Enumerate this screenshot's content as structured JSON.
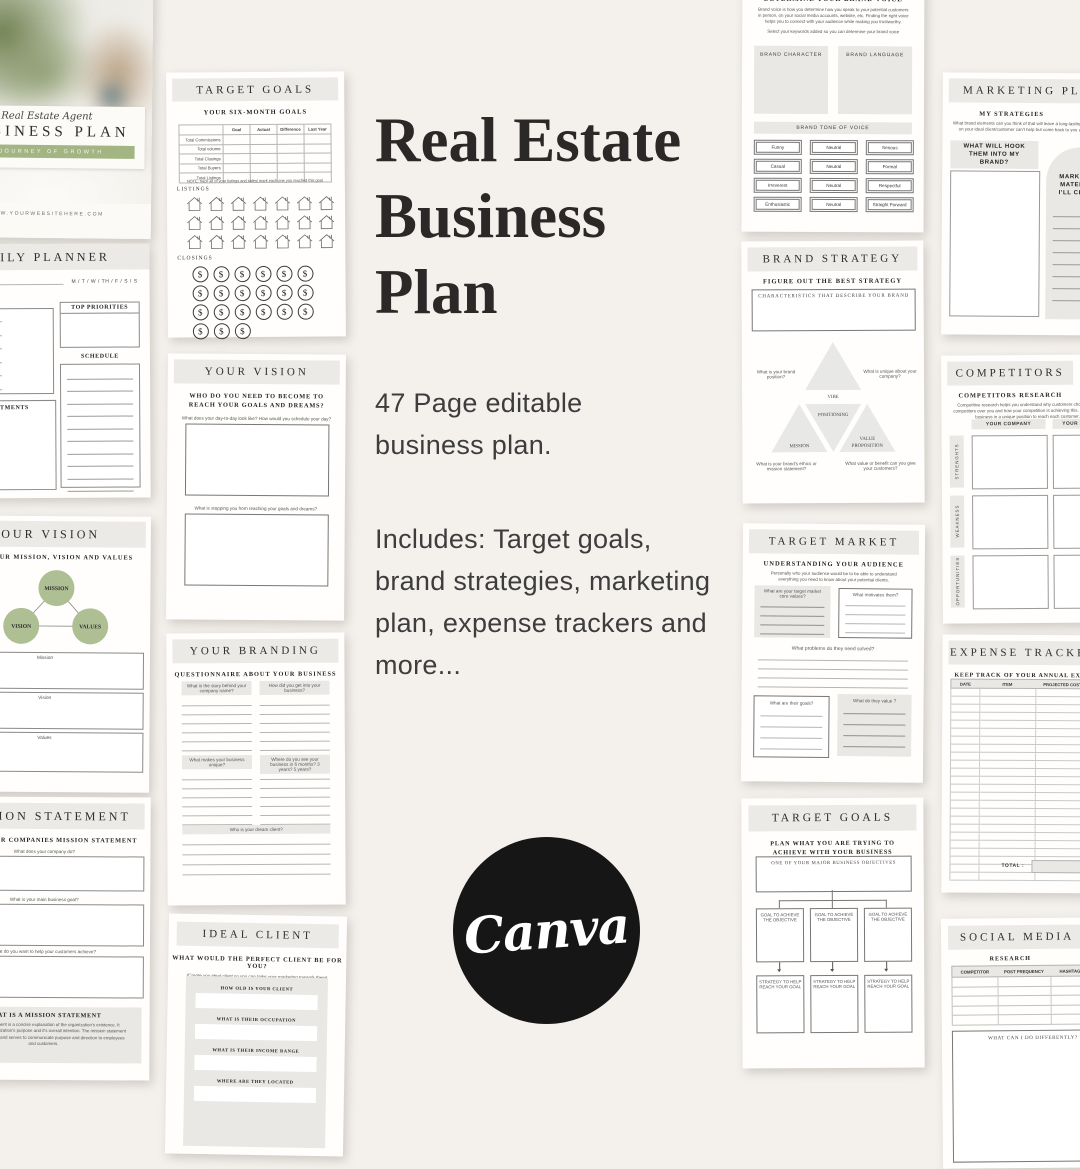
{
  "colors": {
    "bg": "#f4f1ed",
    "paper": "#fffefc",
    "band": "#ebeae7",
    "sage": "#aebf94",
    "sage_dark": "#a3b583",
    "canva": "#161616"
  },
  "center": {
    "title1": "Real Estate",
    "title2": "Business",
    "title3": "Plan",
    "p1": "47 Page editable business plan.",
    "p2": "Includes: Target goals, brand strategies, marketing plan, expense trackers and more...",
    "canva": "Canva"
  },
  "cover": {
    "script": "Real Estate Agent",
    "title": "BUSINESS PLAN",
    "banner": "A JOURNEY OF GROWTH",
    "site": "WWW.YOURWEBSITEHERE.COM"
  },
  "daily": {
    "title": "DAILY PLANNER",
    "days": "M / T / W / TH / F / S / S",
    "todo": "TO - DO LIST:",
    "priorities": "TOP PRIORITIES",
    "schedule": "SCHEDULE",
    "appointments": "APPOINTMENTS"
  },
  "vision1": {
    "title": "YOUR VISION",
    "subtitle": "DEFINE YOUR MISSION, VISION AND VALUES",
    "c1": "MISSION",
    "c2": "VISION",
    "c3": "VALUES",
    "b1": "Mission",
    "b2": "Vision",
    "b3": "Values"
  },
  "mission": {
    "title": "MISSION STATEMENT",
    "subtitle": "CREATE YOUR COMPANIES MISSION STATEMENT",
    "q1": "What does your company do?",
    "q2": "What is your main business goal?",
    "q3": "What do you want to help your customers achieve?",
    "info_title": "WHAT IS A MISSION STATEMENT",
    "info": "A mission statement is a concise explanation of the organization's existence. It describes the organization's purpose and it's overall intention. The mission statement supports the vision and serves to communicate purpose and direction to employees and customers."
  },
  "tg1": {
    "title": "TARGET GOALS",
    "subtitle": "YOUR SIX-MONTH GOALS",
    "cols": [
      "Goal",
      "Actual",
      "Difference",
      "Last Year"
    ],
    "rows": [
      "Total Commissions",
      "Total volume",
      "Total Closings",
      "Total Buyers",
      "Total Listings"
    ],
    "note": "NOTE: track all of your listings and sales/ mark each one you reached this goal",
    "listings": "LISTINGS",
    "closings": "CLOSINGS",
    "dollar": "$"
  },
  "vision2": {
    "title": "YOUR VISION",
    "subtitle": "WHO DO YOU NEED TO BECOME TO REACH YOUR GOALS AND DREAMS?",
    "q1": "What does your day-to-day look like? How would you schedule your day?",
    "q2": "What is stopping you from reaching your goals and dreams?"
  },
  "branding": {
    "title": "YOUR BRANDING",
    "subtitle": "QUESTIONNAIRE ABOUT YOUR BUSINESS",
    "q1": "What is the story behind your company name?",
    "q2": "How did you get into your business?",
    "q3": "What makes your business unique?",
    "q4": "Where do you see your business in 6 months? 3 years? 5 years?",
    "q5": "Who is your dream client?"
  },
  "ideal": {
    "title": "IDEAL CLIENT",
    "subtitle": "WHAT WOULD THE PERFECT CLIENT BE FOR YOU?",
    "note": "(Create you ideal client so you can tailor your marketing towards them)",
    "f1": "HOW OLD IS YOUR CLIENT",
    "f2": "WHAT IS THEIR OCCUPATION",
    "f3": "WHAT IS THEIR INCOME RANGE",
    "f4": "WHERE ARE THEY LOCATED"
  },
  "voice": {
    "title": "DETERMINE YOUR BRAND VOICE",
    "para": "Brand voice is how you determine how you speak to your potential customers in person, on your social media accounts, website, etc. Finding the right voice helps you to connect with your audience while making you trustworthy.",
    "select": "Select your keywords added so you can determine your brand voice",
    "char": "BRAND CHARACTER",
    "lang": "BRAND LANGUAGE",
    "bar": "BRAND TONE OF VOICE",
    "tones": [
      "Funny",
      "Neutral",
      "Serious",
      "Casual",
      "Neutral",
      "Formal",
      "Irreverent",
      "Neutral",
      "Respectful",
      "Enthusiastic",
      "Neutral",
      "Straight Forward"
    ]
  },
  "strategy": {
    "title": "BRAND STRATEGY",
    "subtitle": "FIGURE OUT THE BEST STRATEGY",
    "box": "CHARACTERISTICS THAT DESCRIBE YOUR BRAND",
    "vibe": "VIBE",
    "positioning": "POSITIONING",
    "mission": "MISSION",
    "value1": "VALUE",
    "value2": "PROPOSITION",
    "qtl": "What is your brand position?",
    "qtr": "What is unique about your company?",
    "qbl": "What is your brand's ethics or mission statement?",
    "qbr": "What value or benefit can you give your customers?"
  },
  "market": {
    "title": "TARGET MARKET",
    "subtitle": "UNDERSTANDING YOUR AUDIENCE",
    "para": "Personally who your audience would be to be able to understand everything you need to know about your potential clients.",
    "q1": "What are your target market core values?",
    "q2": "What motivates them?",
    "q3": "What problems do they need solved?",
    "q4": "What are their goals?",
    "q5": "What do they value ?"
  },
  "tg2": {
    "title": "TARGET GOALS",
    "subtitle": "PLAN WHAT YOU ARE TRYING TO ACHIEVE WITH YOUR BUSINESS",
    "objective": "ONE OF YOUR MAJOR BUSINESS OBJECTIVES",
    "goal": "GOAL TO ACHIEVE THE OBJECTIVE",
    "strat": "STRATEGY TO HELP REACH YOUR GOAL"
  },
  "mkt": {
    "title": "MARKETING PLAN",
    "subtitle": "MY STRATEGIES",
    "para": "What brand elements can you think of that will leave a long-lasting impression on your ideal client/customer can't help but come back to you after that?",
    "hook": "WHAT WILL HOOK THEM INTO MY BRAND?",
    "materials": "MARKETING MATERIALS I'LL CREATE"
  },
  "comp": {
    "title": "COMPETITORS",
    "subtitle": "COMPETITORS RESEARCH",
    "para": "Competitive research helps you understand why customers choose your competitors over you and how your competition is achieving this. It puts your business in a unique position to reach each customer.",
    "col1": "YOUR COMPANY",
    "col2": "YOUR COMPETITOR",
    "r1": "STRENGHTS",
    "r2": "WEAKNESS",
    "r3": "OPPORTUNITIES"
  },
  "expense": {
    "title": "EXPENSE TRACKER",
    "subtitle": "KEEP TRACK OF YOUR ANNUAL EXPENSES",
    "c1": "DATE",
    "c2": "ITEM",
    "c3": "PROJECTED COST",
    "total": "TOTAL :"
  },
  "social": {
    "title": "SOCIAL MEDIA",
    "subtitle": "RESEARCH",
    "c1": "COMPETITOR",
    "c2": "POST FREQUENCY",
    "c3": "HASHTAGS",
    "box": "WHAT CAN I DO DIFFERENTLY?"
  }
}
